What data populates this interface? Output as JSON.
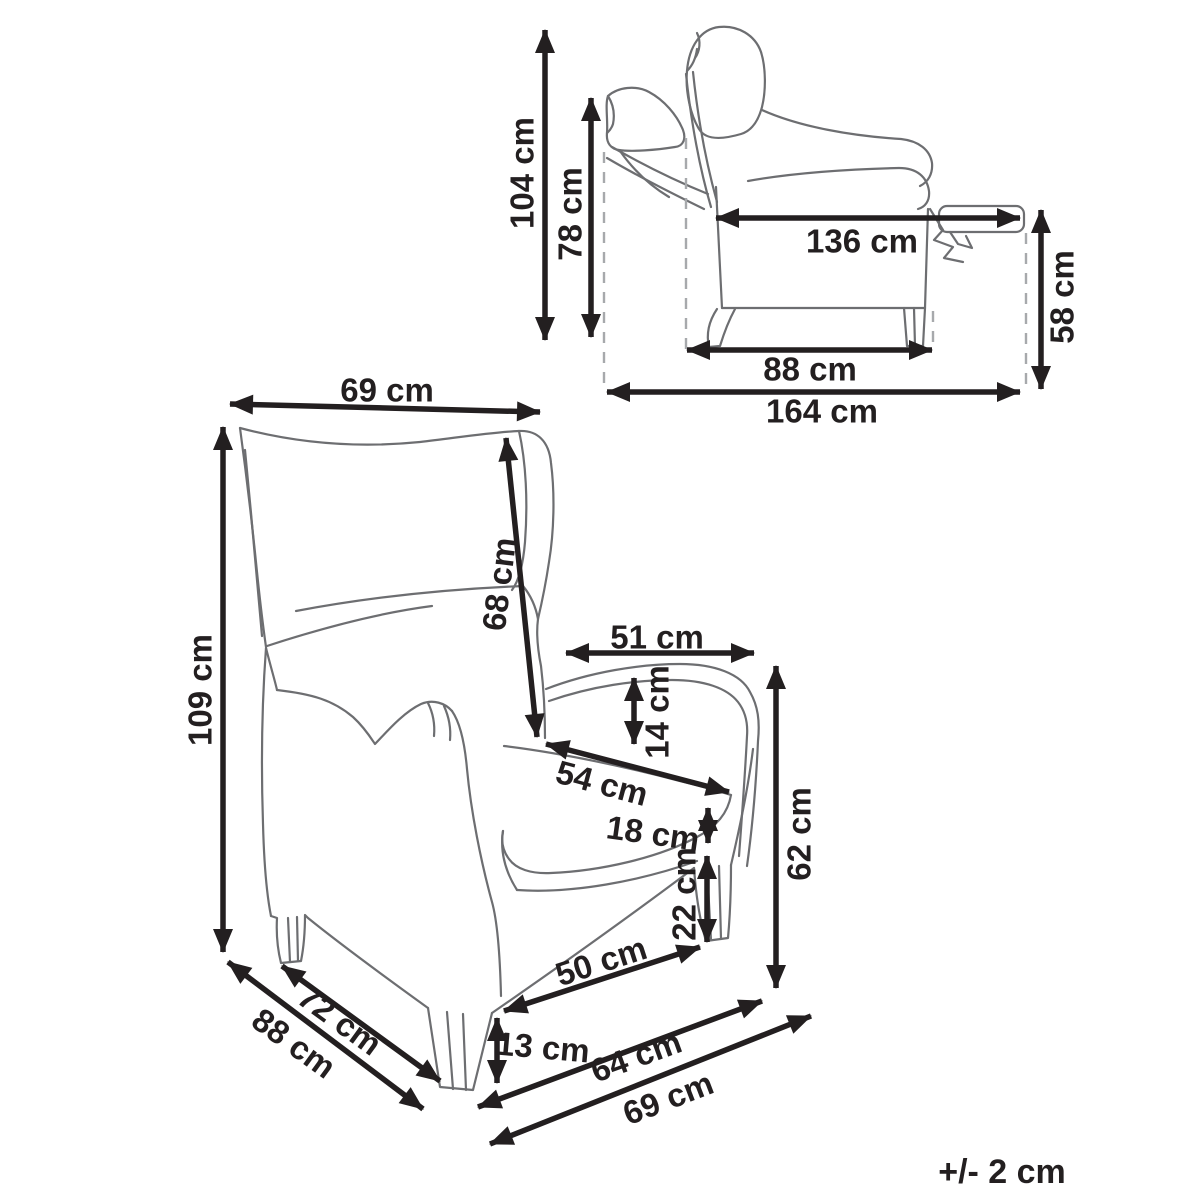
{
  "tolerance_note": "+/- 2 cm",
  "side_view": {
    "title": "recliner-side-view-reclined",
    "dimensions": {
      "total_height": {
        "label": "104 cm"
      },
      "backrest_height": {
        "label": "78 cm"
      },
      "reclined_length": {
        "label": "136 cm"
      },
      "footrest_height": {
        "label": "58 cm"
      },
      "base_depth": {
        "label": "88 cm"
      },
      "total_reclined_depth": {
        "label": "164 cm"
      }
    }
  },
  "front_view": {
    "title": "recliner-front-view",
    "dimensions": {
      "backrest_width": {
        "label": "69 cm"
      },
      "total_height": {
        "label": "109 cm"
      },
      "backrest_length": {
        "label": "68 cm"
      },
      "armrest_length": {
        "label": "51 cm"
      },
      "armrest_thickness": {
        "label": "14 cm"
      },
      "seat_width": {
        "label": "54 cm"
      },
      "seat_front_height": {
        "label": "18 cm"
      },
      "under_seat_clearance": {
        "label": "22 cm"
      },
      "armrest_height": {
        "label": "62 cm"
      },
      "seat_front_width": {
        "label": "50 cm"
      },
      "leg_height": {
        "label": "13 cm"
      },
      "base_front_width": {
        "label": "64 cm"
      },
      "total_width": {
        "label": "69 cm"
      },
      "seat_depth": {
        "label": "72 cm"
      },
      "total_depth": {
        "label": "88 cm"
      }
    }
  }
}
